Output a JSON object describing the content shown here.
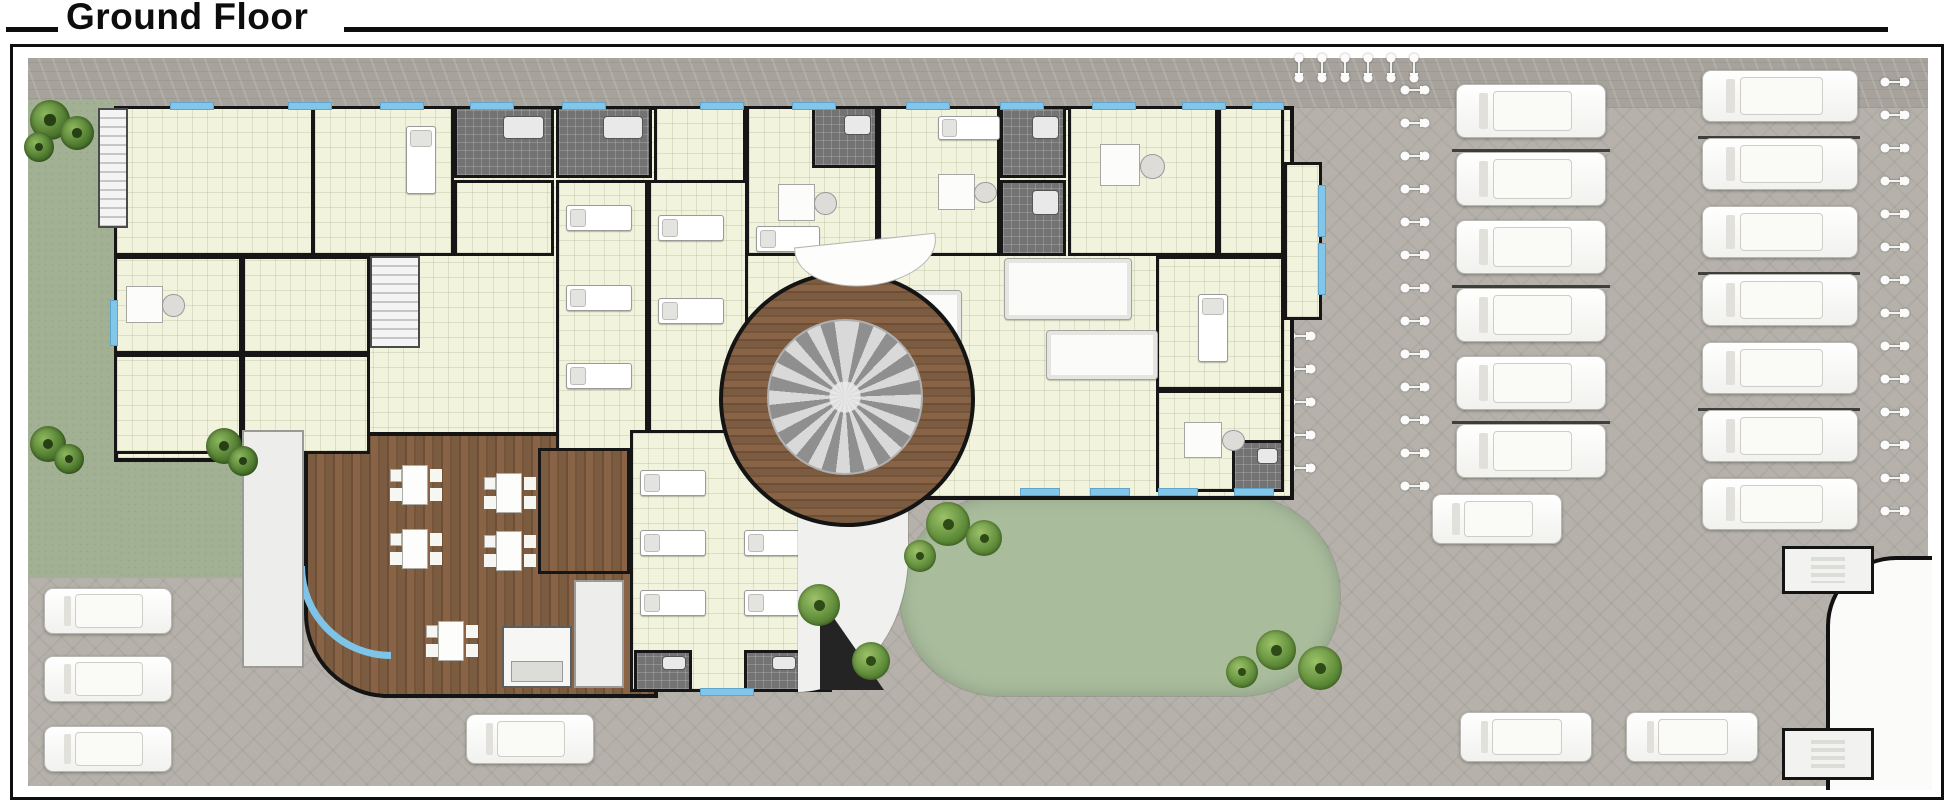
{
  "title": "Ground Floor",
  "palette": {
    "wall": "#161616",
    "room_floor": "#f1f3dc",
    "glass_blue": "#7fc3e8",
    "paving_grey": "#b6b2ab",
    "concrete_band": "#a7a39c",
    "lawn_green": "#a2b194",
    "oval_lawn_green": "#a9bd9d",
    "wood_brown": "#7a5a3e",
    "rug_grey": "#8f8f8f",
    "car_white": "#ffffff",
    "bath_grey": "#737373"
  },
  "icons": {
    "car": "car-top-icon",
    "bicycle": "bicycle-top-icon",
    "tree": "tree-icon",
    "shrub": "shrub-icon",
    "bed": "treatment-bed-icon",
    "desk": "office-desk-icon",
    "dining_table": "dining-table-icon",
    "sofa": "sofa-icon",
    "stairs": "staircase-icon",
    "window": "window-glass",
    "rug": "round-rug-icon",
    "ramp": "ramp-triangle-icon"
  },
  "plan": {
    "schema": "items are [x, y, w, h] in page pixels; rooms add kind as 5th entry",
    "rooms": [
      [
        114,
        106,
        200,
        150,
        "room"
      ],
      [
        312,
        106,
        142,
        150,
        "room"
      ],
      [
        114,
        256,
        128,
        98,
        "room"
      ],
      [
        114,
        354,
        128,
        100,
        "room"
      ],
      [
        242,
        256,
        128,
        98,
        "room"
      ],
      [
        242,
        354,
        128,
        100,
        "room"
      ],
      [
        454,
        106,
        100,
        72,
        "bath"
      ],
      [
        556,
        106,
        96,
        72,
        "bath"
      ],
      [
        454,
        180,
        100,
        76,
        "room"
      ],
      [
        654,
        106,
        92,
        96,
        "room"
      ],
      [
        746,
        106,
        132,
        150,
        "room"
      ],
      [
        812,
        106,
        66,
        62,
        "bath"
      ],
      [
        878,
        106,
        122,
        150,
        "room"
      ],
      [
        1000,
        106,
        66,
        72,
        "bath"
      ],
      [
        1000,
        180,
        66,
        76,
        "bath"
      ],
      [
        1068,
        106,
        150,
        150,
        "room"
      ],
      [
        1218,
        106,
        66,
        150,
        "room"
      ],
      [
        1156,
        256,
        128,
        134,
        "room"
      ],
      [
        1156,
        390,
        128,
        102,
        "room"
      ],
      [
        1232,
        440,
        52,
        52,
        "bath"
      ],
      [
        1284,
        162,
        38,
        158,
        "room"
      ],
      [
        370,
        256,
        50,
        92,
        "stairs"
      ],
      [
        98,
        108,
        30,
        120,
        "stairs"
      ],
      [
        556,
        180,
        92,
        274,
        "room"
      ],
      [
        648,
        180,
        100,
        274,
        "room"
      ],
      [
        630,
        430,
        202,
        262,
        "room"
      ],
      [
        634,
        650,
        58,
        42,
        "bath"
      ],
      [
        744,
        650,
        58,
        42,
        "bath"
      ],
      [
        538,
        448,
        92,
        126,
        "wood"
      ],
      [
        502,
        626,
        70,
        62,
        "kitchen"
      ],
      [
        574,
        580,
        50,
        108,
        "white"
      ],
      [
        242,
        430,
        62,
        238,
        "white"
      ]
    ],
    "windows": [
      [
        170,
        102,
        44,
        8
      ],
      [
        288,
        102,
        44,
        8
      ],
      [
        380,
        102,
        44,
        8
      ],
      [
        470,
        102,
        44,
        8
      ],
      [
        562,
        102,
        44,
        8
      ],
      [
        700,
        102,
        44,
        8
      ],
      [
        792,
        102,
        44,
        8
      ],
      [
        906,
        102,
        44,
        8
      ],
      [
        1000,
        102,
        44,
        8
      ],
      [
        1092,
        102,
        44,
        8
      ],
      [
        1182,
        102,
        44,
        8
      ],
      [
        1252,
        102,
        32,
        8
      ],
      [
        110,
        300,
        8,
        46
      ],
      [
        1318,
        185,
        8,
        52
      ],
      [
        1318,
        243,
        8,
        52
      ],
      [
        1020,
        488,
        40,
        8
      ],
      [
        1090,
        488,
        40,
        8
      ],
      [
        1158,
        488,
        40,
        8
      ],
      [
        1234,
        488,
        40,
        8
      ],
      [
        700,
        688,
        54,
        8
      ]
    ],
    "beds_h": [
      [
        566,
        205,
        66,
        26
      ],
      [
        566,
        285,
        66,
        26
      ],
      [
        566,
        363,
        66,
        26
      ],
      [
        658,
        215,
        66,
        26
      ],
      [
        658,
        298,
        66,
        26
      ],
      [
        756,
        226,
        64,
        26
      ],
      [
        640,
        470,
        66,
        26
      ],
      [
        640,
        530,
        66,
        26
      ],
      [
        640,
        590,
        66,
        26
      ],
      [
        744,
        530,
        66,
        26
      ],
      [
        744,
        590,
        66,
        26
      ],
      [
        938,
        116,
        62,
        24
      ]
    ],
    "beds_v": [
      [
        406,
        126,
        30,
        68
      ],
      [
        1198,
        294,
        30,
        68
      ]
    ],
    "desks": [
      [
        126,
        280,
        60,
        48
      ],
      [
        1100,
        138,
        66,
        54
      ],
      [
        778,
        178,
        60,
        48
      ],
      [
        938,
        168,
        60,
        46
      ],
      [
        1184,
        416,
        62,
        46
      ]
    ],
    "sofas": [
      [
        1004,
        258,
        128,
        62
      ],
      [
        1046,
        330,
        112,
        50
      ],
      [
        850,
        290,
        112,
        68
      ]
    ],
    "tables": [
      [
        392,
        462,
        46,
        46
      ],
      [
        486,
        470,
        46,
        46
      ],
      [
        392,
        526,
        46,
        46
      ],
      [
        486,
        528,
        46,
        46
      ],
      [
        428,
        618,
        46,
        46
      ]
    ],
    "cars": [
      [
        1456,
        84,
        150,
        54
      ],
      [
        1456,
        152,
        150,
        54
      ],
      [
        1456,
        220,
        150,
        54
      ],
      [
        1456,
        288,
        150,
        54
      ],
      [
        1456,
        356,
        150,
        54
      ],
      [
        1456,
        424,
        150,
        54
      ],
      [
        1702,
        70,
        156,
        52
      ],
      [
        1702,
        138,
        156,
        52
      ],
      [
        1702,
        206,
        156,
        52
      ],
      [
        1702,
        274,
        156,
        52
      ],
      [
        1702,
        342,
        156,
        52
      ],
      [
        1702,
        410,
        156,
        52
      ],
      [
        1702,
        478,
        156,
        52
      ],
      [
        1432,
        494,
        130,
        50
      ],
      [
        44,
        588,
        128,
        46
      ],
      [
        44,
        656,
        128,
        46
      ],
      [
        44,
        726,
        128,
        46
      ],
      [
        466,
        714,
        128,
        50
      ],
      [
        1460,
        712,
        132,
        50
      ],
      [
        1626,
        712,
        132,
        50
      ]
    ],
    "bikes": [
      [
        1400,
        84
      ],
      [
        1400,
        117
      ],
      [
        1400,
        150
      ],
      [
        1400,
        183
      ],
      [
        1400,
        216
      ],
      [
        1400,
        249
      ],
      [
        1400,
        282
      ],
      [
        1400,
        315
      ],
      [
        1400,
        348
      ],
      [
        1400,
        381
      ],
      [
        1400,
        414
      ],
      [
        1400,
        447
      ],
      [
        1400,
        480
      ],
      [
        1880,
        76
      ],
      [
        1880,
        109
      ],
      [
        1880,
        142
      ],
      [
        1880,
        175
      ],
      [
        1880,
        208
      ],
      [
        1880,
        241
      ],
      [
        1880,
        274
      ],
      [
        1880,
        307
      ],
      [
        1880,
        340
      ],
      [
        1880,
        373
      ],
      [
        1880,
        406
      ],
      [
        1880,
        439
      ],
      [
        1880,
        472
      ],
      [
        1880,
        505
      ],
      [
        1284,
        62,
        90
      ],
      [
        1307,
        62,
        90
      ],
      [
        1330,
        62,
        90
      ],
      [
        1353,
        62,
        90
      ],
      [
        1376,
        62,
        90
      ],
      [
        1399,
        62,
        90
      ],
      [
        1286,
        330
      ],
      [
        1286,
        363
      ],
      [
        1286,
        396
      ],
      [
        1286,
        429
      ],
      [
        1286,
        462
      ]
    ],
    "trees": [
      [
        30,
        100,
        40
      ],
      [
        60,
        116,
        34
      ],
      [
        24,
        132,
        30
      ],
      [
        30,
        426,
        36
      ],
      [
        54,
        444,
        30
      ],
      [
        206,
        428,
        36
      ],
      [
        228,
        446,
        30
      ]
    ],
    "shrubs": [
      [
        926,
        502,
        44
      ],
      [
        966,
        520,
        36
      ],
      [
        904,
        540,
        32
      ],
      [
        1256,
        630,
        40
      ],
      [
        1298,
        646,
        44
      ],
      [
        1226,
        656,
        32
      ],
      [
        852,
        642,
        38
      ],
      [
        798,
        584,
        42
      ]
    ],
    "stall_lines": [
      [
        1452,
        149,
        158,
        3
      ],
      [
        1452,
        285,
        158,
        3
      ],
      [
        1452,
        421,
        158,
        3
      ],
      [
        1698,
        136,
        162,
        3
      ],
      [
        1698,
        272,
        162,
        3
      ],
      [
        1698,
        408,
        162,
        3
      ]
    ],
    "guards": [
      [
        1782,
        546,
        92,
        48
      ],
      [
        1782,
        728,
        92,
        52
      ]
    ]
  }
}
